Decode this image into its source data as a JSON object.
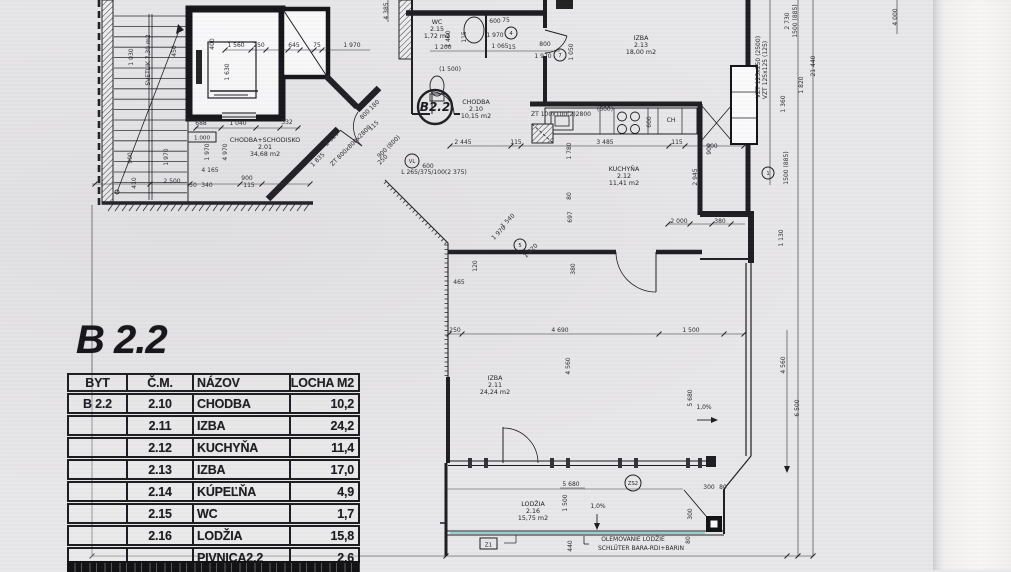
{
  "title": {
    "label": "B 2.2"
  },
  "table": {
    "headers": [
      "BYT",
      "Č.M.",
      "NÁZOV",
      "PLOCHA M2"
    ],
    "rows": [
      [
        "B 2.2",
        "2.10",
        "CHODBA",
        "10,2"
      ],
      [
        "",
        "2.11",
        "IZBA",
        "24,2"
      ],
      [
        "",
        "2.12",
        "KUCHYŇA",
        "11,4"
      ],
      [
        "",
        "2.13",
        "IZBA",
        "17,0"
      ],
      [
        "",
        "2.14",
        "KÚPEĽŇA",
        "4,9"
      ],
      [
        "",
        "2.15",
        "WC",
        "1,7"
      ],
      [
        "",
        "2.16",
        "LODŽIA",
        "15,8"
      ],
      [
        "",
        "",
        "PIVNICA2.2",
        "2,6"
      ]
    ]
  },
  "plan": {
    "rooms": [
      {
        "name": "CHODBA+SCHODISKO",
        "num": "2.01",
        "area": "34,68 m2",
        "x": 265,
        "y": 142
      },
      {
        "name": "WC",
        "num": "2.15",
        "area": "1,72 m2",
        "x": 437,
        "y": 24
      },
      {
        "name": "CHODBA",
        "num": "2.10",
        "area": "10,15 m2",
        "x": 476,
        "y": 104
      },
      {
        "name": "IZBA",
        "num": "2.13",
        "area": "18,00 m2",
        "x": 641,
        "y": 40
      },
      {
        "name": "KUCHYŇA",
        "num": "2.12",
        "area": "11,41 m2",
        "x": 624,
        "y": 171
      },
      {
        "name": "IZBA",
        "num": "2.11",
        "area": "24,24 m2",
        "x": 495,
        "y": 380
      },
      {
        "name": "LODŽIA",
        "num": "2.16",
        "area": "15,75 m2",
        "x": 533,
        "y": 506
      }
    ],
    "dims": [
      [
        "1 560",
        236,
        47
      ],
      [
        "250",
        259,
        47
      ],
      [
        "645",
        294,
        47
      ],
      [
        "75",
        317,
        47
      ],
      [
        "1 970",
        352,
        47
      ],
      [
        "688",
        201,
        125
      ],
      [
        "1 040",
        238,
        125
      ],
      [
        "332",
        287,
        124
      ],
      [
        "4 165",
        210,
        172
      ],
      [
        "2 500",
        172,
        183
      ],
      [
        "50",
        193,
        187
      ],
      [
        "340",
        207,
        187
      ],
      [
        "900",
        247,
        180
      ],
      [
        "115",
        249,
        187
      ],
      [
        "410",
        136,
        183,
        -90
      ],
      [
        "1 030",
        133,
        57,
        -90
      ],
      [
        "900",
        132,
        158,
        -90
      ],
      [
        "1 970",
        168,
        157,
        -90
      ],
      [
        "1 970",
        209,
        152,
        -90
      ],
      [
        "4 970",
        227,
        152,
        -90
      ],
      [
        "1 630",
        229,
        72,
        -90
      ],
      [
        "450",
        176,
        51,
        -90
      ],
      [
        "400",
        214,
        44,
        -90
      ],
      [
        "4 385",
        388,
        11,
        -90
      ],
      [
        "600",
        495,
        23
      ],
      [
        "75",
        506,
        22
      ],
      [
        "1 970",
        495,
        37
      ],
      [
        "1 400",
        450,
        39,
        -90
      ],
      [
        "115",
        466,
        37,
        -90
      ],
      [
        "1 200",
        443,
        49
      ],
      [
        "(1 500)",
        450,
        71
      ],
      [
        "1 065",
        500,
        48
      ],
      [
        "15",
        512,
        49
      ],
      [
        "800",
        545,
        46
      ],
      [
        "1 970",
        543,
        58
      ],
      [
        "1 050",
        573,
        52,
        -90
      ],
      [
        "2 925",
        333,
        140,
        -45
      ],
      [
        "1 835",
        319,
        161,
        -45
      ],
      [
        "800 180",
        371,
        111,
        -45
      ],
      [
        "115",
        375,
        127,
        -45
      ],
      [
        "900 (800)",
        390,
        148,
        -45
      ],
      [
        "250",
        384,
        161,
        -45
      ],
      [
        "2 445",
        463,
        144
      ],
      [
        "115",
        516,
        144
      ],
      [
        "3 485",
        605,
        144
      ],
      [
        "115",
        677,
        144
      ],
      [
        "900",
        712,
        148
      ],
      [
        "600",
        428,
        168
      ],
      [
        "1 780",
        571,
        151,
        -90
      ],
      [
        "(600)",
        605,
        111
      ],
      [
        "600",
        651,
        122,
        -90
      ],
      [
        "2 945",
        697,
        177,
        -90
      ],
      [
        "2 000",
        679,
        223
      ],
      [
        "380",
        720,
        223
      ],
      [
        "1 130",
        783,
        238,
        -90
      ],
      [
        "80",
        571,
        196,
        -90
      ],
      [
        "697",
        572,
        217,
        -90
      ],
      [
        "380",
        575,
        269,
        -90
      ],
      [
        "1 540",
        509,
        222,
        -45
      ],
      [
        "1 970",
        500,
        234,
        -45
      ],
      [
        "1 820",
        532,
        252,
        -45
      ],
      [
        "120",
        477,
        266,
        -90
      ],
      [
        "465",
        459,
        284
      ],
      [
        "250",
        455,
        332
      ],
      [
        "4 690",
        560,
        332
      ],
      [
        "1 500",
        691,
        332
      ],
      [
        "4 560",
        570,
        366,
        -90
      ],
      [
        "5 680",
        692,
        398,
        -90
      ],
      [
        "5 680",
        571,
        486
      ],
      [
        "1 500",
        567,
        503,
        -90
      ],
      [
        "440",
        572,
        546,
        -90
      ],
      [
        "300",
        692,
        514,
        -90
      ],
      [
        "80",
        690,
        540,
        -90
      ],
      [
        "300",
        709,
        489
      ],
      [
        "80",
        723,
        489
      ],
      [
        "900",
        711,
        149,
        -90
      ],
      [
        "2 730",
        789,
        21,
        -90
      ],
      [
        "1500 (885)",
        797,
        21,
        -90
      ],
      [
        "21 440",
        815,
        66,
        -90
      ],
      [
        "1 820",
        803,
        85,
        -90
      ],
      [
        "1 360",
        785,
        104,
        -90
      ],
      [
        "1500 (885)",
        788,
        168,
        -90
      ],
      [
        "4 560",
        785,
        365,
        -90
      ],
      [
        "6 500",
        799,
        408,
        -90
      ],
      [
        "4 000",
        897,
        17,
        -90
      ]
    ],
    "notes": [
      [
        "ZT 800x800x2800",
        352,
        147,
        -45
      ],
      [
        "ZT 100x100(2)2800",
        561,
        116,
        0
      ],
      [
        "L 265/375/100(2 375)",
        434,
        174,
        0
      ],
      [
        "VZT 125x250 (2500)",
        760,
        67,
        -90
      ],
      [
        "VZT 125x125 (125)",
        767,
        70,
        -90
      ],
      [
        "OLEMOVANIE LODŽIE",
        633,
        541,
        0
      ],
      [
        "SCHLÜTER BARA-RDI+BARIN",
        641,
        550,
        0
      ],
      [
        "1,0%",
        598,
        508,
        0
      ],
      [
        "1,0%",
        704,
        409,
        0
      ],
      [
        "CH",
        671,
        122,
        0
      ],
      [
        "SVETLIK 7,30 m2",
        150,
        60,
        -90
      ]
    ],
    "circles": [
      {
        "t": "B2.2",
        "x": 435,
        "y": 107,
        "r": 17,
        "big": true
      },
      {
        "t": "4",
        "x": 511,
        "y": 33,
        "r": 6
      },
      {
        "t": "7",
        "x": 560,
        "y": 55,
        "r": 6
      },
      {
        "t": "VL",
        "x": 412,
        "y": 161,
        "r": 7
      },
      {
        "t": "5",
        "x": 520,
        "y": 245,
        "r": 6
      },
      {
        "t": "1",
        "x": 768,
        "y": 173,
        "r": 6
      },
      {
        "t": "ZS2",
        "x": 633,
        "y": 483,
        "r": 8
      }
    ],
    "boxes": [
      {
        "t": "Z1",
        "x": 480,
        "y": 538,
        "w": 17,
        "h": 11
      },
      {
        "t": "1.000",
        "x": 188,
        "y": 132,
        "w": 28,
        "h": 10
      }
    ],
    "accent_color": "#5fc8c0",
    "line_color": "#1d1d22"
  }
}
